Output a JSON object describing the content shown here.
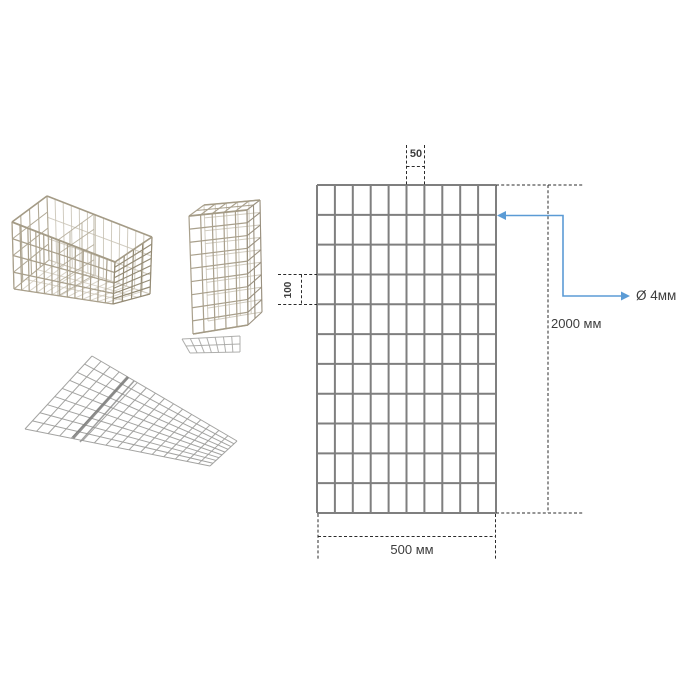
{
  "photos": [
    {
      "name": "gabion-basket-long"
    },
    {
      "name": "gabion-basket-tall"
    },
    {
      "name": "mesh-panels-flat"
    }
  ],
  "diagram": {
    "mesh": {
      "columns": 10,
      "rows": 11
    },
    "labels": {
      "cell_width": "50",
      "cell_height": "100",
      "panel_width": "500 мм",
      "panel_height": "2000 мм",
      "wire_diameter": "Ø 4мм"
    },
    "colors": {
      "grid_line": "#7f7f7f",
      "dash_line": "#2b2b2b",
      "annotation_blue": "#5b9bd5",
      "text": "#3d3d3d"
    }
  }
}
